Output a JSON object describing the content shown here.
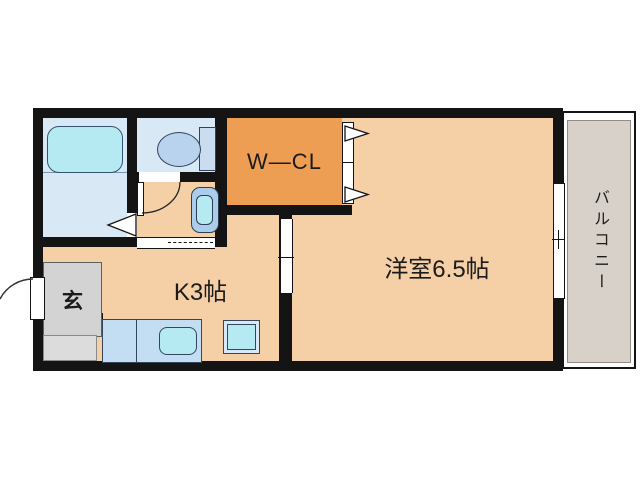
{
  "plan": {
    "rooms": {
      "western_room": {
        "label": "洋室6.5帖"
      },
      "kitchen": {
        "label": "K3帖"
      },
      "entrance": {
        "label": "玄"
      },
      "walk_in_closet": {
        "label": "W—CL"
      },
      "balcony": {
        "label": "バルコニー"
      }
    },
    "colors": {
      "wall": "#141414",
      "floor": "#f5cfa6",
      "closet": "#ee9e53",
      "bath": "#d9e8f5",
      "fixture_cyan": "#b5eaf3",
      "fixture_blue": "#c3ddf2",
      "genkan": "#d3d3d3",
      "genkan_step": "#dcdcdc",
      "balcony": "#d7d1c9"
    }
  }
}
